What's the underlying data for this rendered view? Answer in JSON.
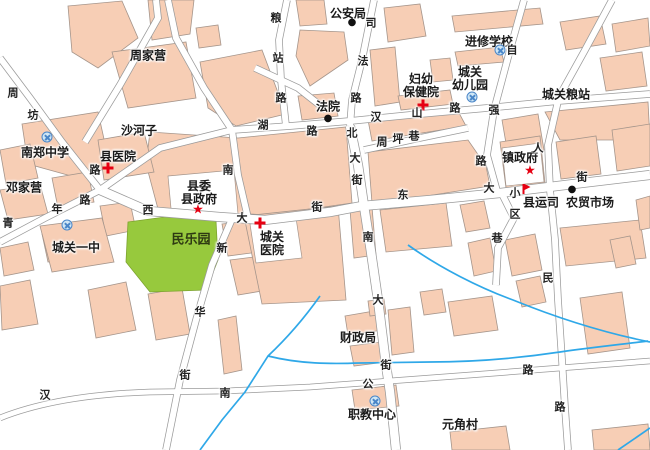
{
  "map": {
    "pois": [
      {
        "id": "zhoujiaying",
        "label": "周家营",
        "marker": "none"
      },
      {
        "id": "gonganju",
        "label": "公安局",
        "marker": "dot"
      },
      {
        "id": "jinxiuxuexiao",
        "label": "进修学校",
        "marker": "school"
      },
      {
        "id": "fuyoubaojianyuan",
        "label": "妇幼\n保健院",
        "marker": "cross"
      },
      {
        "id": "chengguanyoueryuan",
        "label": "城关\n幼儿园",
        "marker": "school"
      },
      {
        "id": "chengguanliangzhan",
        "label": "城关粮站",
        "marker": "none"
      },
      {
        "id": "shahezi",
        "label": "沙河子",
        "marker": "none"
      },
      {
        "id": "fayuan",
        "label": "法院",
        "marker": "dot"
      },
      {
        "id": "nanzhengzhongxue",
        "label": "南郑中学",
        "marker": "school"
      },
      {
        "id": "xianyiyuan",
        "label": "县医院",
        "marker": "cross"
      },
      {
        "id": "dengjiaying",
        "label": "邓家营",
        "marker": "none"
      },
      {
        "id": "xianweixianzhengfu",
        "label": "县委\n县政府",
        "marker": "star"
      },
      {
        "id": "chengguanyizhong",
        "label": "城关一中",
        "marker": "school"
      },
      {
        "id": "minleyuan",
        "label": "民乐园",
        "marker": "none"
      },
      {
        "id": "chengguanyiyuan",
        "label": "城关\n医院",
        "marker": "cross"
      },
      {
        "id": "zhenzhengfu",
        "label": "镇政府",
        "marker": "star"
      },
      {
        "id": "xianyunsi",
        "label": "县运司",
        "marker": "flag"
      },
      {
        "id": "nongmaoshichang",
        "label": "农贸市场",
        "marker": "dot"
      },
      {
        "id": "caizhengju",
        "label": "财政局",
        "marker": "none"
      },
      {
        "id": "zhijiaozhongxin",
        "label": "职教中心",
        "marker": "school"
      },
      {
        "id": "yuanjiaocun",
        "label": "元角村",
        "marker": "none"
      }
    ],
    "roads": [
      {
        "name": "周坊路",
        "chars": [
          "周",
          "坊",
          "路"
        ]
      },
      {
        "name": "粮站路",
        "chars": [
          "粮",
          "站",
          "路"
        ]
      },
      {
        "name": "司法路",
        "chars": [
          "司",
          "法",
          "路"
        ]
      },
      {
        "name": "南湖路",
        "chars": [
          "南",
          "湖",
          "路"
        ]
      },
      {
        "name": "汉山路",
        "chars": [
          "汉",
          "山",
          "路"
        ]
      },
      {
        "name": "自强路",
        "chars": [
          "自",
          "强",
          "路"
        ]
      },
      {
        "name": "周坪巷",
        "chars": [
          "周",
          "坪",
          "巷"
        ]
      },
      {
        "name": "北大街",
        "chars": [
          "北",
          "大",
          "街"
        ]
      },
      {
        "name": "西大街",
        "chars": [
          "西",
          "大",
          "街"
        ]
      },
      {
        "name": "东大街",
        "chars": [
          "东",
          "大",
          "街"
        ]
      },
      {
        "name": "南大街",
        "chars": [
          "南",
          "大",
          "街"
        ]
      },
      {
        "name": "青年路",
        "chars": [
          "青",
          "年",
          "路"
        ]
      },
      {
        "name": "新华街",
        "chars": [
          "新",
          "华",
          "街"
        ]
      },
      {
        "name": "汉南公路",
        "chars": [
          "汉",
          "南",
          "公",
          "路"
        ]
      },
      {
        "name": "人民路",
        "chars": [
          "人",
          "民",
          "路"
        ]
      },
      {
        "name": "小区巷",
        "chars": [
          "小",
          "区",
          "巷"
        ]
      }
    ],
    "icons": {
      "star": "★",
      "dot": "●",
      "cross": "red-cross-css-shape",
      "school": "blue-circle-x-css-shape",
      "flag": "red-flag-css-shape"
    },
    "colors": {
      "block": "#F7CEB5",
      "block_border": "#A5958B",
      "road_fill": "#FFFFFF",
      "road_casing": "#9A9A9A",
      "park": "#97C93D",
      "river": "#2FA8E8",
      "marker_red": "#E60012",
      "text": "#1A1A1A"
    }
  }
}
